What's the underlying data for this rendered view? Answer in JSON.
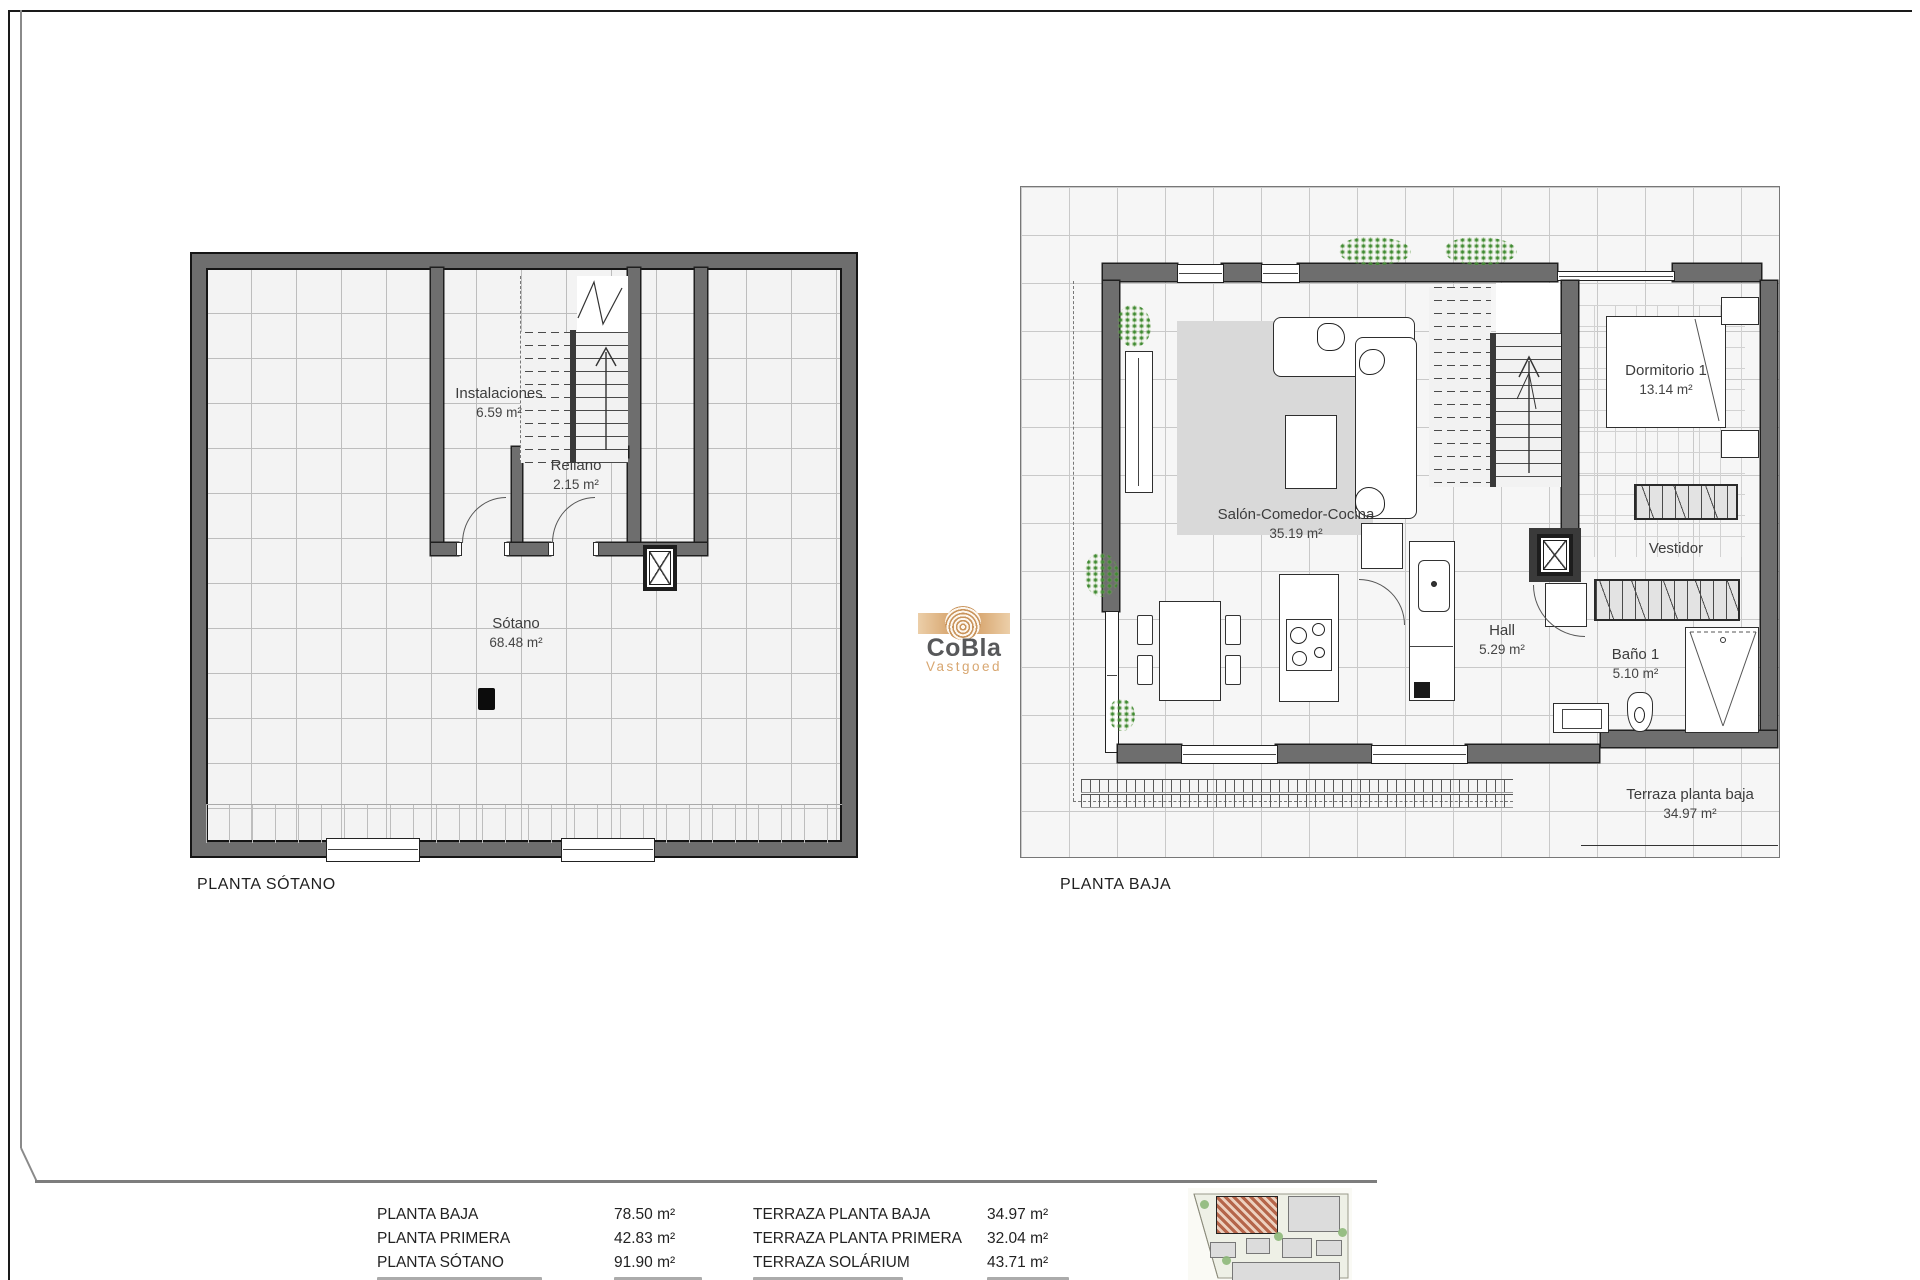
{
  "logo": {
    "name": "CoBla",
    "subtitle": "Vastgoed",
    "accent_color": "#d8a771",
    "text_color": "#57585a"
  },
  "plan_sotano": {
    "title": "PLANTA SÓTANO",
    "room_instalaciones_name": "Instalaciones",
    "room_instalaciones_area": "6.59 m²",
    "room_rellano_name": "Rellano",
    "room_rellano_area": "2.15 m²",
    "room_sotano_name": "Sótano",
    "room_sotano_area": "68.48 m²"
  },
  "plan_baja": {
    "title": "PLANTA BAJA",
    "room_salon_name": "Salón-Comedor-Cocina",
    "room_salon_area": "35.19 m²",
    "room_dormitorio_name": "Dormitorio 1",
    "room_dormitorio_area": "13.14 m²",
    "room_vestidor_name": "Vestidor",
    "room_hall_name": "Hall",
    "room_hall_area": "5.29 m²",
    "room_bano_name": "Baño 1",
    "room_bano_area": "5.10 m²",
    "room_terraza_name": "Terraza planta baja",
    "room_terraza_area": "34.97 m²"
  },
  "areas_table": {
    "rows": [
      {
        "label_left": "PLANTA BAJA",
        "value_left": "78.50 m²",
        "label_right": "TERRAZA PLANTA BAJA",
        "value_right": "34.97 m²"
      },
      {
        "label_left": "PLANTA PRIMERA",
        "value_left": "42.83 m²",
        "label_right": "TERRAZA PLANTA PRIMERA",
        "value_right": "32.04 m²"
      },
      {
        "label_left": "PLANTA SÓTANO",
        "value_left": "91.90 m²",
        "label_right": "TERRAZA SOLÁRIUM",
        "value_right": "43.71 m²"
      }
    ],
    "fourth_row_clipped": true
  },
  "colors": {
    "wall": "#6e6e6e",
    "wall_edge": "#1c1c1c",
    "grid_fill": "#f4f4f4",
    "grid_line": "#c4c4c4",
    "rug": "#d9d9d9",
    "plant_green": "#4e9b3c",
    "site_highlight": "#b5654a"
  }
}
